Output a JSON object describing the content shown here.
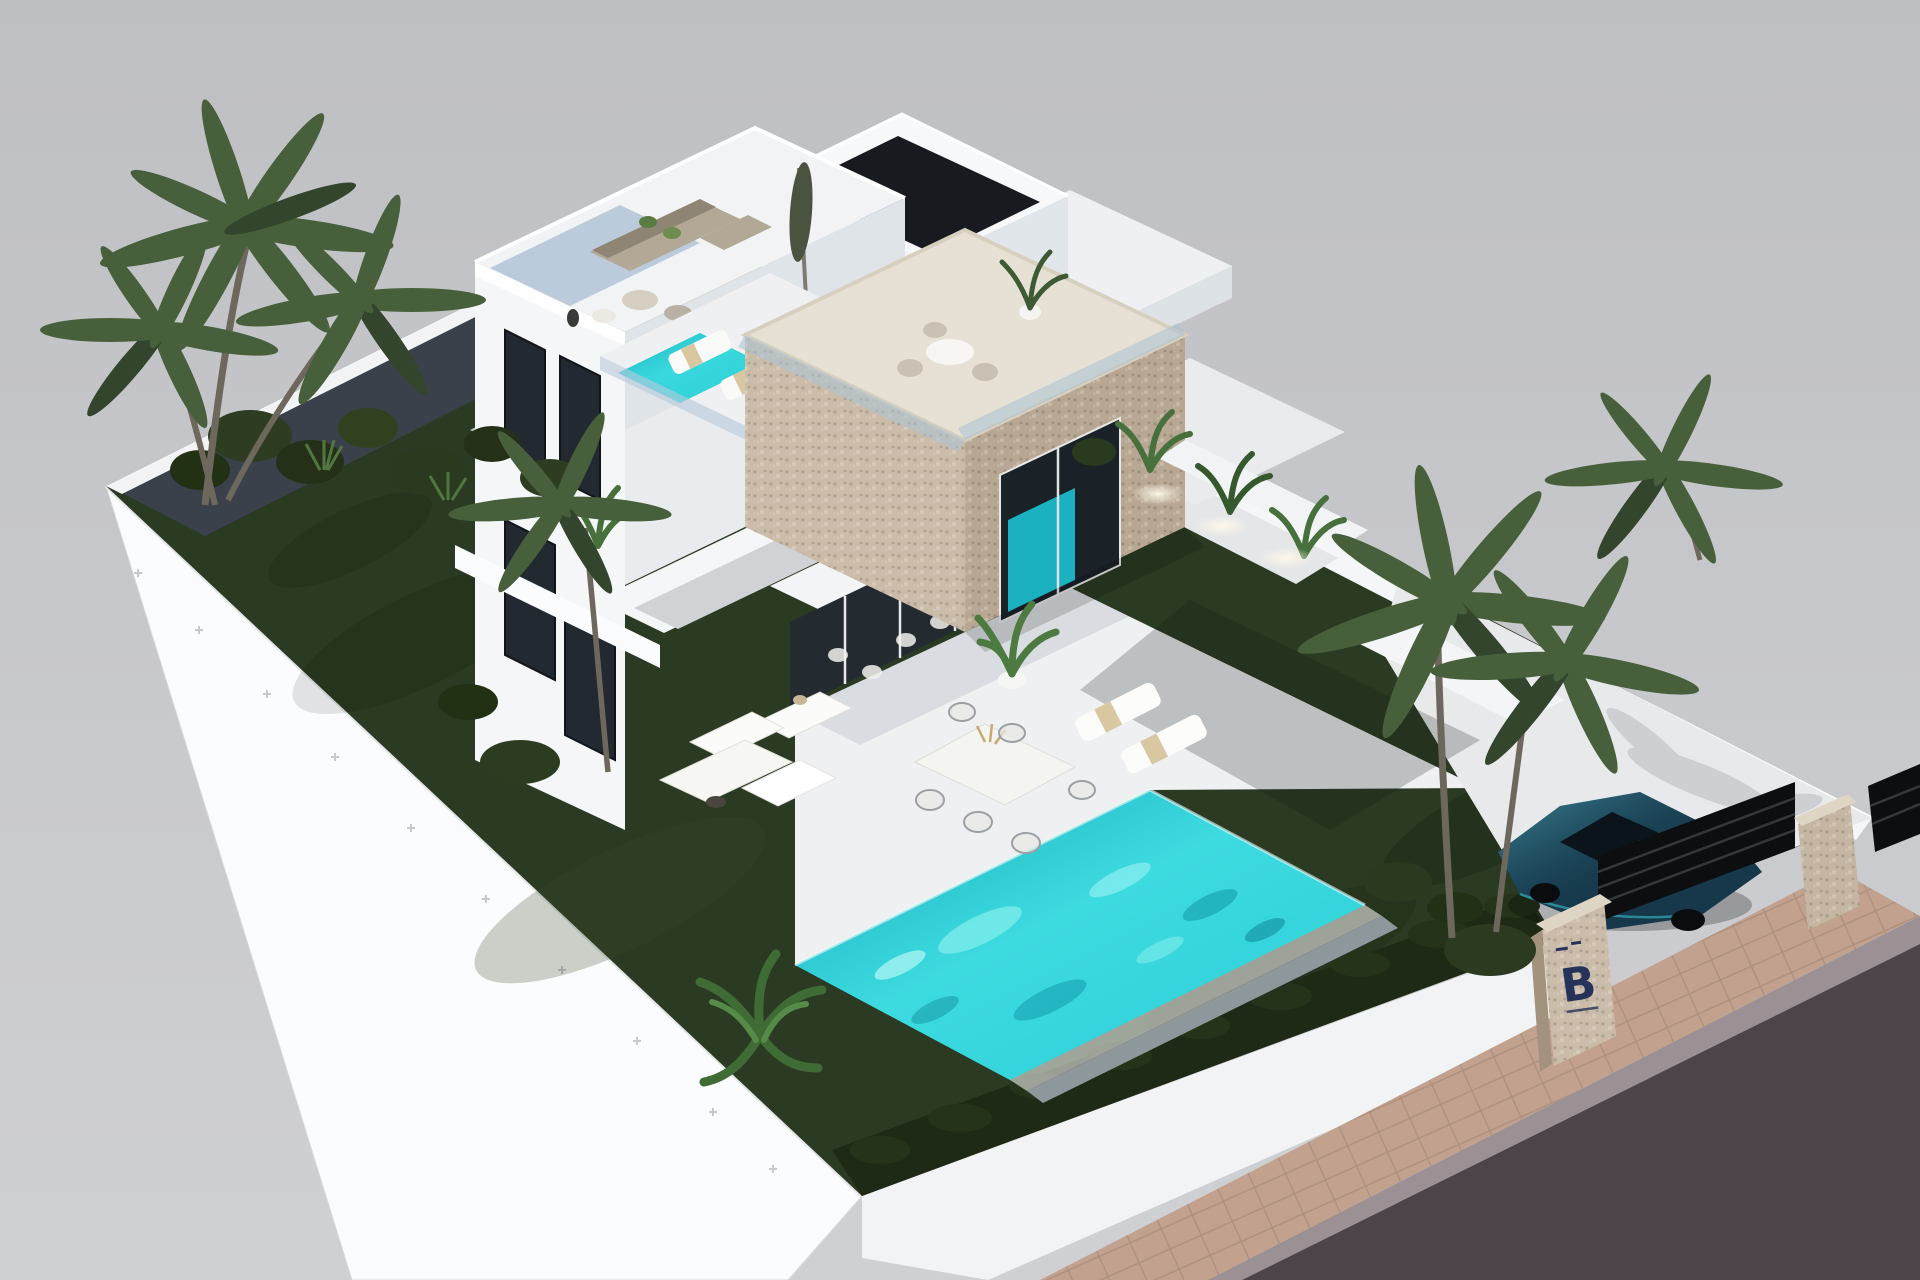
{
  "scene": {
    "type": "3d-architectural-render",
    "description": "Aerial isometric rendering of a modern two-storey white villa with a stone-clad cube volume, roof terraces with lounge furniture, a plunge pool, a large turquoise infinity pool, dark green lawn, palm trees, perimeter walls with uplights, and a gated driveway with a dark blue car beside a stone pillar bearing a B logo",
    "logo": {
      "letter": "B"
    },
    "objects": [
      "villa",
      "stone-cube",
      "roof-terrace",
      "plunge-pool",
      "infinity-pool",
      "lawn",
      "palm-trees",
      "hedge",
      "garden-lounge-set",
      "outdoor-dining-set",
      "sun-loungers",
      "driveway",
      "car",
      "entrance-gate",
      "stone-pillars",
      "sidewalk",
      "road"
    ]
  },
  "palette": {
    "background": "#c6c7ca",
    "base_white": "#fbfcfd",
    "terrace_white": "#eef0f2",
    "lawn_green": "#2b3a22",
    "hedge_green": "#1f2a16",
    "palm_green": "#47603b",
    "gravel_dark": "#3a414b",
    "pool_turquoise": "#2fd2d8",
    "stone_beige": "#cbbcaa",
    "glass_blue": "#a9bdd2",
    "road_asphalt": "#4c4449",
    "sidewalk_tan": "#c2a28e",
    "car_blue": "#16384a",
    "logo_navy": "#25335a"
  }
}
